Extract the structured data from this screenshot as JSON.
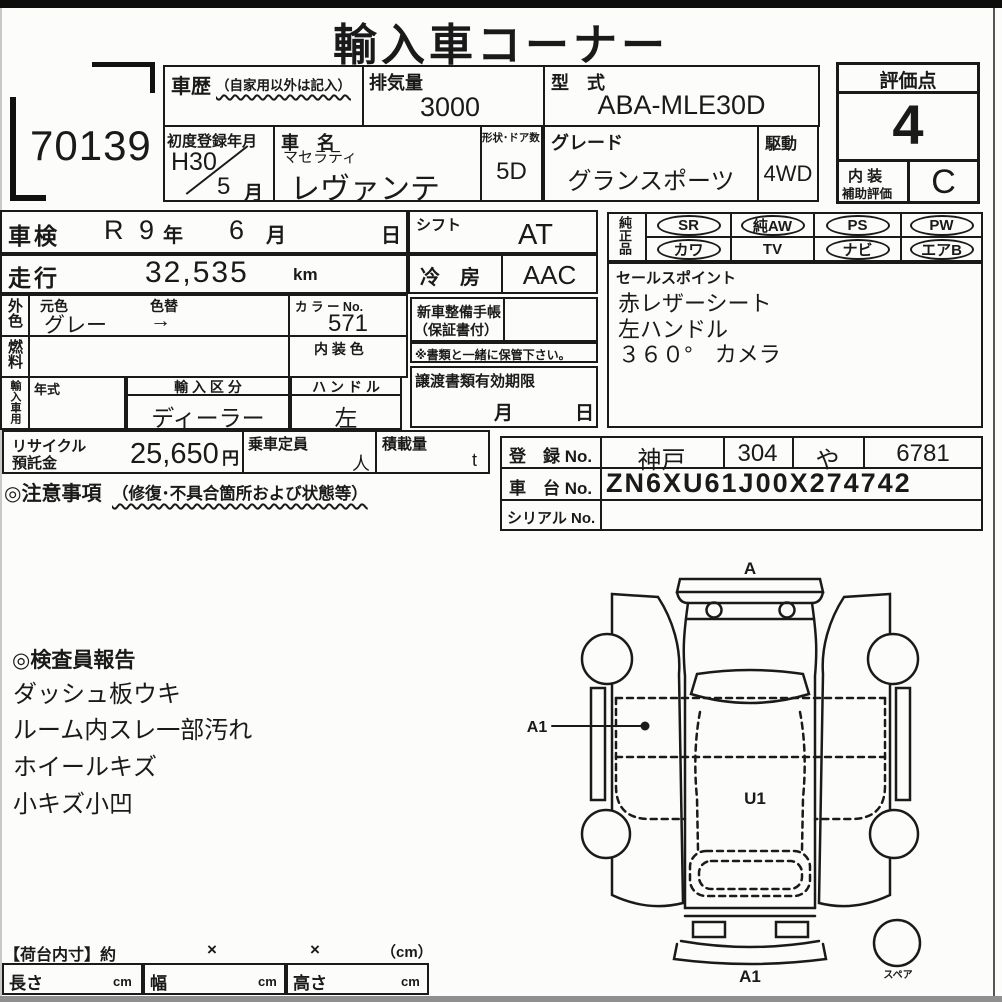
{
  "page": {
    "title": "輸入車コーナー",
    "lot_no": "70139"
  },
  "header": {
    "history": {
      "label": "車歴",
      "note": "（自家用以外は記入）"
    },
    "displacement": {
      "label": "排気量",
      "value": "3000"
    },
    "model_code": {
      "label": "型　式",
      "value": "ABA-MLE30D"
    },
    "first_reg": {
      "label": "初度登録年月",
      "era": "H30",
      "month": "5",
      "month_unit": "月"
    },
    "car_name": {
      "label": "車　名",
      "maker": "マセラティ",
      "model": "レヴァンテ"
    },
    "shape_doors": {
      "label": "形状･ドア数",
      "value": "5D"
    },
    "grade": {
      "label": "グレード",
      "value": "グランスポーツ"
    },
    "drive": {
      "label": "駆動",
      "value": "4WD"
    },
    "score": {
      "label": "評価点",
      "value": "4",
      "interior_label1": "内 装",
      "interior_label2": "補助評価",
      "interior_value": "C"
    }
  },
  "left_table": {
    "shaken": {
      "label": "車検",
      "era": "R 9",
      "year_unit": "年",
      "month": "6",
      "month_unit": "月",
      "day_unit": "日"
    },
    "mileage": {
      "label": "走行",
      "value": "32,535",
      "unit": "km"
    },
    "exterior": {
      "label": "外色",
      "orig_label": "元色",
      "change_label": "色替",
      "value": "グレー",
      "arrow": "→",
      "color_no_label": "カ ラ ー No.",
      "color_no": "571",
      "interior_color_label": "内 装 色"
    },
    "fuel": {
      "label": "燃料"
    },
    "import_use": {
      "label": "輸入車用",
      "year_label": "年式",
      "division_label": "輸 入 区 分",
      "division": "ディーラー",
      "handle_label": "ハ ン ド ル",
      "handle": "左"
    },
    "recycle": {
      "label1": "リサイクル",
      "label2": "預託金",
      "value": "25,650",
      "unit": "円",
      "capacity_label": "乗車定員",
      "capacity_unit": "人",
      "load_label": "積載量",
      "load_unit": "t"
    },
    "caution": {
      "label": "◎注意事項",
      "note": "（修復･不具合箇所および状態等）"
    }
  },
  "mid_table": {
    "shift": {
      "label": "シフト",
      "value": "AT"
    },
    "cooling": {
      "label": "冷　房",
      "value": "AAC"
    },
    "maintenance_book": {
      "line1": "新車整備手帳",
      "line2": "（保証書付）",
      "note": "※書類と一緒に保管下さい。"
    },
    "transfer_docs": {
      "label": "譲渡書類有効期限",
      "month_unit": "月",
      "day_unit": "日"
    }
  },
  "equipment": {
    "label": "純正品",
    "items": [
      {
        "label": "SR",
        "circled": true
      },
      {
        "label": "純AW",
        "circled": true
      },
      {
        "label": "PS",
        "circled": true
      },
      {
        "label": "PW",
        "circled": true
      },
      {
        "label": "カワ",
        "circled": true
      },
      {
        "label": "TV",
        "circled": false
      },
      {
        "label": "ナビ",
        "circled": true
      },
      {
        "label": "エアB",
        "circled": true
      }
    ]
  },
  "sales_points": {
    "label": "セールスポイント",
    "items": [
      "赤レザーシート",
      "左ハンドル",
      "３６０°　カメラ"
    ]
  },
  "registration": {
    "reg_label": "登　録 No.",
    "area": "神戸",
    "class_no": "304",
    "kana": "や",
    "number": "6781",
    "chassis_label": "車　台 No.",
    "chassis_no": "ZN6XU61J00X274742",
    "serial_label": "シリアル No.",
    "serial_no": ""
  },
  "inspector_report": {
    "title": "◎検査員報告",
    "items": [
      "ダッシュ板ウキ",
      "ルーム内スレ一部汚れ",
      "ホイールキズ",
      "小キズ小凹"
    ]
  },
  "cargo_dims": {
    "title": "【荷台内寸】約",
    "times1": "×",
    "times2": "×",
    "unit_note": "（cm）",
    "cells": [
      {
        "label": "長さ",
        "unit": "cm"
      },
      {
        "label": "幅",
        "unit": "cm"
      },
      {
        "label": "高さ",
        "unit": "cm"
      }
    ]
  },
  "diagram": {
    "front_label": "A",
    "left_panel_label": "A1",
    "roof_label": "U1",
    "rear_label": "A1",
    "spare_label": "スペア"
  },
  "colors": {
    "ink": "#1a1a1a",
    "paper": "#fcfcfa"
  }
}
